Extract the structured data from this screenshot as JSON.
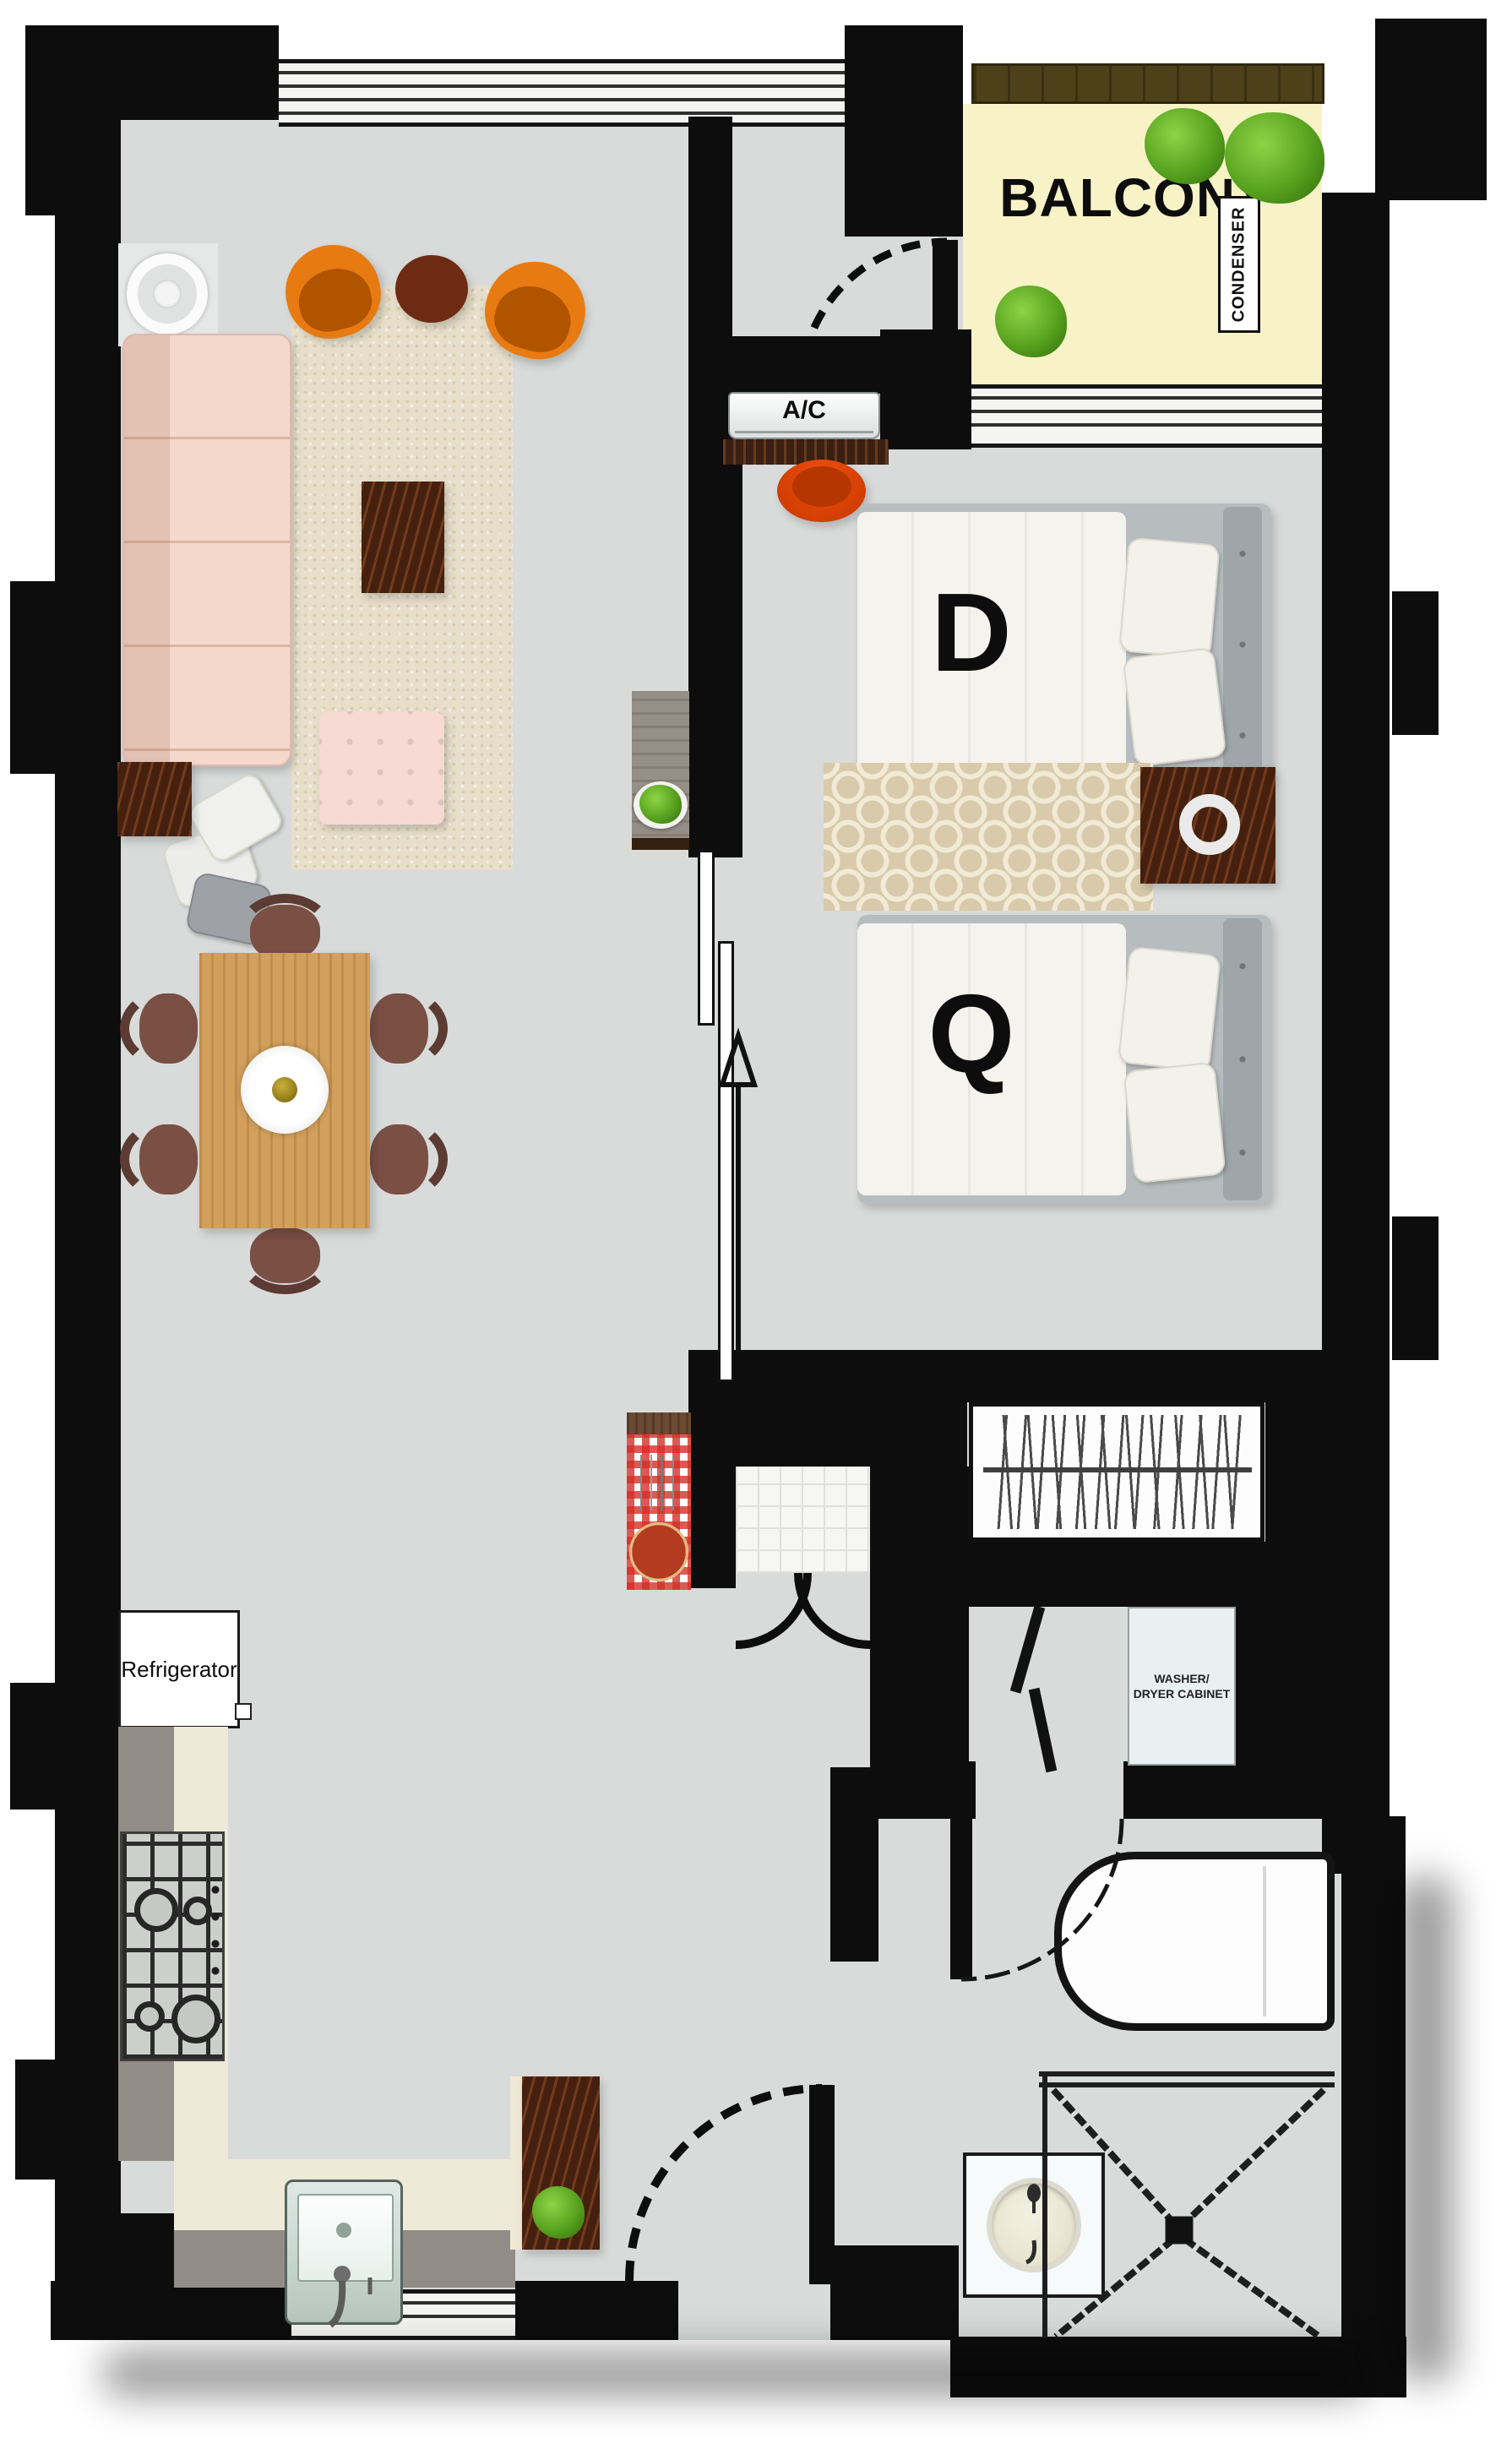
{
  "labels": {
    "balcony": "BALCONY",
    "condenser": "CONDENSER",
    "ac": "A/C",
    "bed_double": "D",
    "bed_queen": "Q",
    "refrigerator": "Refrigerator",
    "washer_dryer_line1": "WASHER/",
    "washer_dryer_line2": "DRYER CABINET"
  },
  "colors": {
    "wall": "#0D0D0D",
    "floor": "#D8DBDA",
    "balcony_floor": "#F7F3C6",
    "planter": "#4E4119",
    "shrub": "#57A21F",
    "sofa": "#F4D8CB",
    "accent_chair": "#E87A12",
    "rug_living": "#E7DFC9",
    "rug_trellis": "#D8CAAA",
    "wood_light": "#D2A05C",
    "wood_dark": "#46200F",
    "bedding": "#F4F3ED",
    "headboard": "#9FA5A9",
    "counter_cream": "#EFE9D8",
    "checker_red": "#D2332C"
  },
  "icons": {
    "shrub-icon": "green-blob",
    "plant-icon": "green-blob",
    "table-lamp-icon": "concentric-rings",
    "nightstand-lamp-icon": "white-ring",
    "pizza-icon": "orange-circle",
    "cutlery-icon": "thin-lines",
    "hanger-icon": "slanted-lines",
    "direction-arrow-icon": "up-arrow",
    "door-swing-icon": "quarter-arc",
    "centerpiece-icon": "plate-with-gold-center"
  }
}
